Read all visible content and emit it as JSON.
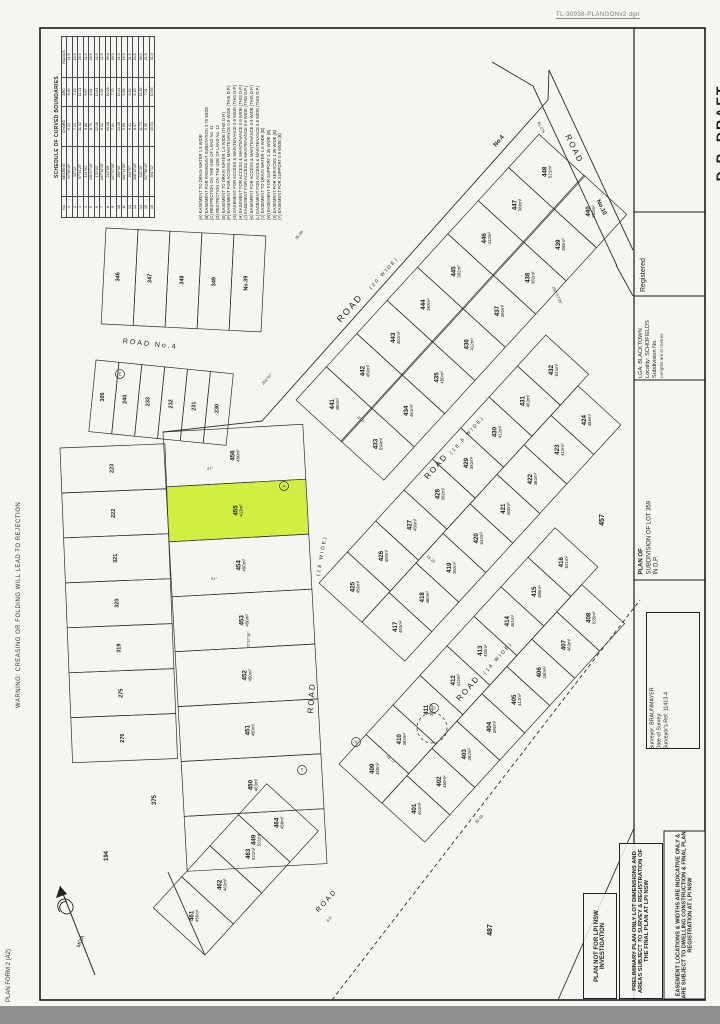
{
  "page": {
    "note": "TL-30938-PLANGONv2 dgn",
    "warning_left": "WARNING: CREASING OR FOLDING WILL LEAD TO REJECTION",
    "form_label": "PLAN FORM 2 (A2)"
  },
  "title_panel": {
    "dp_draft": "D.P. DRAFT",
    "registered": "Registered",
    "lga": "LGA:  BLACKTOWN",
    "locality": "Locality:  SCHOFIELDS",
    "subdivision_no": "Subdivision No.",
    "lengths_note": "Lengths are in metres",
    "plan_of": "PLAN OF",
    "plan_title_1": "SUBDIVISION OF LOT 359",
    "plan_title_2": "IN D.P.",
    "surveyor": "Surveyor:  BRAUNMAYER",
    "date_of_survey": "Date of Survey:",
    "surveyors_ref": "Surveyor's Ref:  11413-4"
  },
  "stamps": [
    "PLAN NOT FOR LPI NSW INVESTIGATION",
    "PRELIMINARY PLAN ONLY LOT DIMENSIONS AND AREAS SUBJECT TO SURVEY & REGISTRATION OF THE FINAL PLAN AT LPI NSW",
    "EASEMENT LOCATIONS & WIDTHS ARE INDICATIVE ONLY & ARE SUBJECT TO DWELLING CONSTRUCTION & FINAL PLAN REGISTRATION AT LPI NSW"
  ],
  "schedule": {
    "title": "SCHEDULE OF CURVED BOUNDARIES",
    "headers": [
      "No.",
      "BEARING",
      "CHORD",
      "ARC",
      "RADIUS"
    ],
    "rows": [
      [
        "1",
        "34°56'40\"",
        "5.24",
        "5.26",
        "21.5"
      ],
      [
        "2",
        "62°12'",
        "7.13",
        "7.19",
        "16.5"
      ],
      [
        "3",
        "97°34'25\"",
        "11.02",
        "11.21",
        "26.5"
      ],
      [
        "4",
        "124°51'",
        "9.88",
        "9.97",
        "31.0"
      ],
      [
        "5",
        "151°07'40\"",
        "8.75",
        "8.81",
        "26.5"
      ],
      [
        "6",
        "170°22'",
        "12.46",
        "12.61",
        "41.0"
      ],
      [
        "7",
        "197°46'15\"",
        "6.32",
        "6.35",
        "21.5"
      ],
      [
        "8",
        "212°09'",
        "10.18",
        "10.29",
        "36.0"
      ],
      [
        "9",
        "247°57'35\"",
        "7.64",
        "7.70",
        "26.5"
      ],
      [
        "10",
        "265°30'",
        "13.25",
        "13.44",
        "41.0"
      ],
      [
        "11",
        "281°44'50\"",
        "5.86",
        "5.89",
        "16.5"
      ],
      [
        "12",
        "292°57'",
        "9.41",
        "9.52",
        "31.0"
      ],
      [
        "13",
        "308°15'30\"",
        "8.07",
        "8.15",
        "26.5"
      ],
      [
        "14",
        "322°40'",
        "11.73",
        "11.90",
        "36.0"
      ],
      [
        "15",
        "337°58'45\"",
        "6.95",
        "7.01",
        "21.5"
      ],
      [
        "16",
        "351°12'",
        "10.54",
        "10.66",
        "31.0"
      ]
    ]
  },
  "easements": [
    {
      "k": "A",
      "t": "EASEMENT TO DRAIN WATER 1.5 WIDE"
    },
    {
      "k": "B",
      "t": "EASEMENT FOR PADMOUNT SUBSTATION 2.75 WIDE"
    },
    {
      "k": "C",
      "t": "RESTRICTION ON THE USE OF LAND No. 11"
    },
    {
      "k": "D",
      "t": "RESTRICTION ON THE USE OF LAND No. 12"
    },
    {
      "k": "E",
      "t": "EASEMENT TO DRAIN WATER 1.5 WIDE (THIS D.P.)"
    },
    {
      "k": "F",
      "t": "EASEMENT FOR ACCESS & MAINTENANCE 0.9 WIDE (THIS D.P.)"
    },
    {
      "k": "G",
      "t": "EASEMENT FOR ACCESS & MAINTENANCE 0.9 WIDE (THIS D.P.)"
    },
    {
      "k": "H",
      "t": "EASEMENT FOR ACCESS & MAINTENANCE 0.9 WIDE (THIS D.P.)"
    },
    {
      "k": "J",
      "t": "EASEMENT FOR ACCESS & MAINTENANCE 0.9 WIDE (THIS D.P.)"
    },
    {
      "k": "K",
      "t": "EASEMENT FOR ACCESS & MAINTENANCE 0.9 WIDE (THIS D.P.)"
    },
    {
      "k": "L",
      "t": "EASEMENT FOR ACCESS & MAINTENANCE 0.9 WIDE (THIS D.P.)"
    },
    {
      "k": "V",
      "t": "EASEMENT TO DRAIN WATER 1.5 WIDE (B)"
    },
    {
      "k": "W",
      "t": "EASEMENT FOR SUPPORT 1.35 WIDE (B)"
    },
    {
      "k": "X",
      "t": "EASEMENT FOR SERVICES 1.35 WIDE (B)"
    },
    {
      "k": "Y",
      "t": "EASEMENT FOR SUPPORT 0.9 WIDE (B)"
    }
  ],
  "highlight_color": "#cdee2e",
  "compass": {
    "label": "MGA"
  },
  "map": {
    "bands": [
      {
        "name": "row-top",
        "x": 296,
        "y": 400,
        "dx": 0.675,
        "dy": -0.738,
        "nx": 0.738,
        "ny": 0.675,
        "w": 45,
        "depth": 62,
        "count": 8,
        "start": 441,
        "step": 1,
        "areas": [
          "450m²",
          "450m²",
          "461m²",
          "382m²",
          "382m²",
          "412m²",
          "386m²",
          "521m²"
        ]
      },
      {
        "name": "row-2",
        "x": 341,
        "y": 441,
        "dx": 0.675,
        "dy": -0.738,
        "nx": 0.738,
        "ny": 0.675,
        "w": 45,
        "depth": 58,
        "count": 8,
        "start": 433,
        "step": 1,
        "areas": [
          "594m²",
          "461m²",
          "450m²",
          "412m²",
          "382m²",
          "382m²",
          "382m²",
          "382m²"
        ]
      },
      {
        "name": "row-3",
        "x": 319,
        "y": 583,
        "dx": 0.675,
        "dy": -0.738,
        "nx": 0.738,
        "ny": 0.675,
        "w": 42,
        "depth": 58,
        "count": 8,
        "start": 425,
        "step": 1,
        "areas": [
          "450m²",
          "450m²",
          "450m²",
          "382m²",
          "382m²",
          "412m²",
          "463m²",
          "521m²"
        ]
      },
      {
        "name": "row-4",
        "x": 362,
        "y": 622,
        "dx": 0.675,
        "dy": -0.738,
        "nx": 0.738,
        "ny": 0.675,
        "w": 40,
        "depth": 58,
        "count": 8,
        "start": 417,
        "step": 1,
        "areas": [
          "453m²",
          "460m²",
          "382m²",
          "642m²",
          "600m²",
          "382m²",
          "412m²",
          "455m²"
        ]
      },
      {
        "name": "row-5",
        "x": 339,
        "y": 764,
        "dx": 0.675,
        "dy": -0.738,
        "nx": 0.738,
        "ny": 0.675,
        "w": 40,
        "depth": 58,
        "count": 8,
        "start": 409,
        "step": 1,
        "areas": [
          "450m²",
          "382m²",
          "382m²",
          "412m²",
          "450m²",
          "461m²",
          "386m²",
          "521m²"
        ]
      },
      {
        "name": "row-6",
        "x": 382,
        "y": 803,
        "dx": 0.675,
        "dy": -0.738,
        "nx": 0.738,
        "ny": 0.675,
        "w": 37,
        "depth": 58,
        "count": 8,
        "start": 401,
        "step": 1,
        "areas": [
          "461m²",
          "450m²",
          "382m²",
          "382m²",
          "412m²",
          "450m²",
          "463m²",
          "635m²"
        ]
      },
      {
        "name": "left-column",
        "x": 163,
        "y": 432,
        "dx": 0.055,
        "dy": 0.9985,
        "nx": 0.9985,
        "ny": -0.055,
        "w": 55,
        "depth": 140,
        "count": 8,
        "start": 456,
        "step": -1,
        "highlight": 1,
        "areas": [
          "450m²",
          "413m²",
          "450m²",
          "450m²",
          "450m²",
          "450m²",
          "463m²",
          "521m²"
        ]
      },
      {
        "name": "bl-cluster",
        "x": 205,
        "y": 955,
        "dx": 0.675,
        "dy": -0.738,
        "nx": -0.738,
        "ny": -0.675,
        "w": 42,
        "depth": 70,
        "count": 4,
        "start": 461,
        "step": 1,
        "areas": [
          "450m²",
          "463m²",
          "521m²",
          "458m²"
        ]
      },
      {
        "name": "tl-block",
        "x": 106,
        "y": 228,
        "dx": 0.999,
        "dy": 0.05,
        "nx": -0.05,
        "ny": 0.999,
        "w": 32,
        "depth": 96,
        "count": 5,
        "nums": [
          "346",
          "347",
          "348",
          "349",
          "No.39"
        ]
      },
      {
        "name": "strip-row",
        "x": 96,
        "y": 360,
        "dx": 0.995,
        "dy": 0.1,
        "nx": -0.1,
        "ny": 0.995,
        "w": 23,
        "depth": 72,
        "count": 6,
        "nums": [
          "305",
          "240",
          "233",
          "232",
          "231",
          "230"
        ]
      },
      {
        "name": "left-fan",
        "x": 60,
        "y": 448,
        "dx": 0.04,
        "dy": 0.999,
        "nx": 0.999,
        "ny": -0.04,
        "w": 45,
        "depth": 105,
        "count": 7,
        "nums": [
          "223",
          "222",
          "321",
          "320",
          "319",
          "275",
          "276"
        ]
      }
    ],
    "road_labels": [
      {
        "t": "ROAD",
        "x": 352,
        "y": 310,
        "r": -48.5,
        "s": 9
      },
      {
        "t": "(20 WIDE)",
        "x": 385,
        "y": 274,
        "r": -48.5,
        "s": 5
      },
      {
        "t": "ROAD",
        "x": 438,
        "y": 468,
        "r": -48.5,
        "s": 8
      },
      {
        "t": "(18.5 WIDE)",
        "x": 468,
        "y": 436,
        "r": -48.5,
        "s": 5
      },
      {
        "t": "ROAD",
        "x": 470,
        "y": 690,
        "r": -48.5,
        "s": 8
      },
      {
        "t": "(16 WIDE)",
        "x": 499,
        "y": 659,
        "r": -48.5,
        "s": 5
      },
      {
        "t": "ROAD",
        "x": 314,
        "y": 698,
        "r": -86,
        "s": 8
      },
      {
        "t": "(18 WIDE)",
        "x": 323,
        "y": 556,
        "r": -80,
        "s": 5
      },
      {
        "t": "ROAD",
        "x": 328,
        "y": 902,
        "r": -48.5,
        "s": 7
      },
      {
        "t": "ROAD No.4",
        "x": 150,
        "y": 346,
        "r": 6,
        "s": 7
      },
      {
        "t": "ROAD",
        "x": 572,
        "y": 150,
        "r": 64,
        "s": 8
      }
    ],
    "outside_labels": [
      {
        "t": "457",
        "x": 604,
        "y": 520,
        "r": -90,
        "s": 7
      },
      {
        "t": "487",
        "x": 492,
        "y": 930,
        "r": -90,
        "s": 7
      },
      {
        "t": "375",
        "x": 156,
        "y": 800,
        "r": -90,
        "s": 6
      },
      {
        "t": "194",
        "x": 108,
        "y": 856,
        "r": -90,
        "s": 6
      },
      {
        "t": "No.4",
        "x": 500,
        "y": 142,
        "r": -50,
        "s": 6
      },
      {
        "t": "No.10",
        "x": 600,
        "y": 208,
        "r": 64,
        "s": 6
      }
    ],
    "annotations": [
      {
        "t": "202°57'35\"",
        "x": 556,
        "y": 296,
        "r": 64
      },
      {
        "t": "292°57'",
        "x": 268,
        "y": 380,
        "r": -48
      },
      {
        "t": "61.275",
        "x": 540,
        "y": 128,
        "r": 64
      },
      {
        "t": "35.09",
        "x": 300,
        "y": 236,
        "r": -48
      },
      {
        "t": "33.5",
        "x": 360,
        "y": 420,
        "r": 40
      },
      {
        "t": "18.29",
        "x": 430,
        "y": 560,
        "r": 40
      },
      {
        "t": "22°57'35\"",
        "x": 250,
        "y": 640,
        "r": -88
      },
      {
        "t": "45.72",
        "x": 390,
        "y": 760,
        "r": 40
      },
      {
        "t": "30.48",
        "x": 480,
        "y": 820,
        "r": -48
      },
      {
        "t": "97°",
        "x": 210,
        "y": 470,
        "r": 0
      },
      {
        "t": "91°",
        "x": 214,
        "y": 580,
        "r": 0
      },
      {
        "t": "6.0",
        "x": 330,
        "y": 920,
        "r": -48
      }
    ],
    "segments": [
      {
        "x1": 262,
        "y1": 421,
        "x2": 548,
        "y2": 100
      },
      {
        "x1": 262,
        "y1": 421,
        "x2": 163,
        "y2": 432
      },
      {
        "x1": 549,
        "y1": 70,
        "x2": 633,
        "y2": 250
      },
      {
        "x1": 533,
        "y1": 86,
        "x2": 617,
        "y2": 266
      },
      {
        "x1": 492,
        "y1": 62,
        "x2": 533,
        "y2": 86
      },
      {
        "x1": 548,
        "y1": 100,
        "x2": 549,
        "y2": 70
      },
      {
        "x1": 616,
        "y1": 265,
        "x2": 633,
        "y2": 296
      },
      {
        "x1": 168,
        "y1": 872,
        "x2": 205,
        "y2": 955
      },
      {
        "x1": 332,
        "y1": 1000,
        "x2": 640,
        "y2": 600,
        "dash": 1
      },
      {
        "x1": 558,
        "y1": 1000,
        "x2": 634,
        "y2": 828
      }
    ],
    "circle_letters": [
      {
        "k": "A",
        "x": 284,
        "y": 486
      },
      {
        "k": "V",
        "x": 356,
        "y": 742
      },
      {
        "k": "T",
        "x": 302,
        "y": 770
      },
      {
        "k": "D",
        "x": 434,
        "y": 708
      },
      {
        "k": "E",
        "x": 120,
        "y": 374
      }
    ],
    "dashed_circle": {
      "x": 432,
      "y": 728,
      "r": 15
    }
  }
}
